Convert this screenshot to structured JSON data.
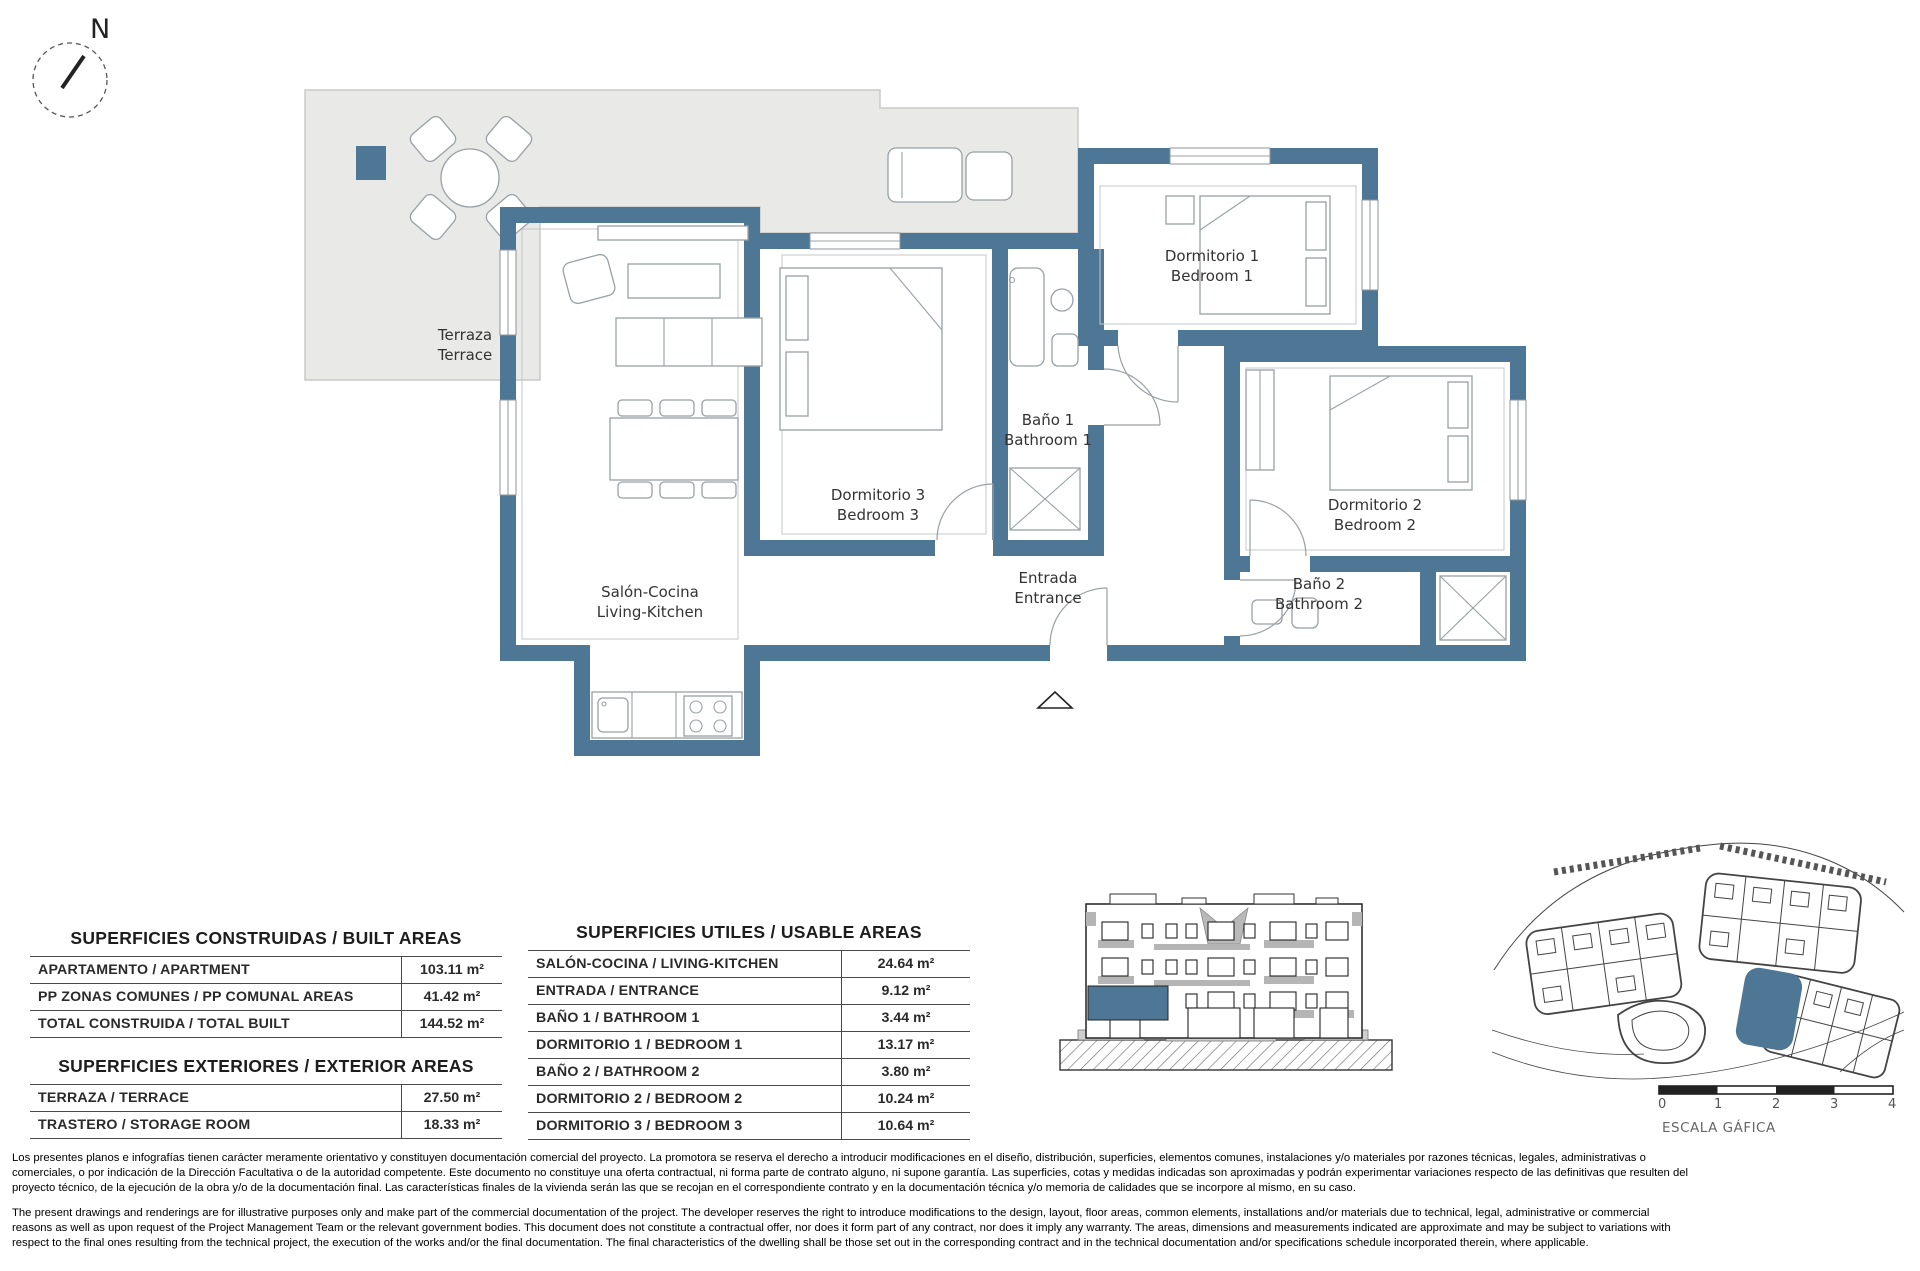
{
  "compass": {
    "north_label": "N"
  },
  "floor_plan": {
    "wall_color": "#4e7795",
    "terrace_color": "#e9e9e7",
    "rooms": [
      {
        "id": "terraza",
        "es": "Terraza",
        "en": "Terrace"
      },
      {
        "id": "salon",
        "es": "Salón-Cocina",
        "en": "Living-Kitchen"
      },
      {
        "id": "dorm3",
        "es": "Dormitorio 3",
        "en": "Bedroom 3"
      },
      {
        "id": "dorm1",
        "es": "Dormitorio 1",
        "en": "Bedroom 1"
      },
      {
        "id": "bano1",
        "es": "Baño 1",
        "en": "Bathroom 1"
      },
      {
        "id": "entrada",
        "es": "Entrada",
        "en": "Entrance"
      },
      {
        "id": "dorm2",
        "es": "Dormitorio 2",
        "en": "Bedroom 2"
      },
      {
        "id": "bano2",
        "es": "Baño 2",
        "en": "Bathroom 2"
      }
    ]
  },
  "areas_tables": {
    "built": {
      "title": "SUPERFICIES CONSTRUIDAS / BUILT AREAS",
      "rows": [
        {
          "label": "APARTAMENTO / APARTMENT",
          "value": "103.11 m²"
        },
        {
          "label": "PP ZONAS COMUNES / PP COMUNAL AREAS",
          "value": "41.42 m²"
        },
        {
          "label": "TOTAL CONSTRUIDA / TOTAL BUILT",
          "value": "144.52 m²"
        }
      ]
    },
    "exterior": {
      "title": "SUPERFICIES EXTERIORES / EXTERIOR AREAS",
      "rows": [
        {
          "label": "TERRAZA / TERRACE",
          "value": "27.50 m²"
        },
        {
          "label": "TRASTERO / STORAGE ROOM",
          "value": "18.33 m²"
        }
      ]
    },
    "usable": {
      "title": "SUPERFICIES UTILES / USABLE AREAS",
      "rows": [
        {
          "label": "SALÓN-COCINA / LIVING-KITCHEN",
          "value": "24.64 m²"
        },
        {
          "label": "ENTRADA / ENTRANCE",
          "value": "9.12 m²"
        },
        {
          "label": "BAÑO 1 / BATHROOM 1",
          "value": "3.44 m²"
        },
        {
          "label": "DORMITORIO 1 / BEDROOM 1",
          "value": "13.17 m²"
        },
        {
          "label": "BAÑO 2 / BATHROOM 2",
          "value": "3.80 m²"
        },
        {
          "label": "DORMITORIO 2 / BEDROOM 2",
          "value": "10.24 m²"
        },
        {
          "label": "DORMITORIO 3 / BEDROOM 3",
          "value": "10.64 m²"
        }
      ]
    }
  },
  "scale_bar": {
    "ticks": [
      "0",
      "1",
      "2",
      "3",
      "4"
    ],
    "label": "ESCALA GÁFICA"
  },
  "legal": {
    "es_lines": [
      "Los presentes planos e infografías tienen carácter meramente orientativo y constituyen documentación comercial del proyecto. La promotora se reserva el derecho a introducir modificaciones en el diseño, distribución, superficies, elementos comunes, instalaciones y/o materiales por razones técnicas, legales, administrativas o",
      "comerciales, o por indicación de la Dirección Facultativa o de la autoridad competente. Este documento no constituye una oferta contractual, ni forma parte de contrato alguno, ni supone garantía. Las superficies, cotas y medidas indicadas son aproximadas y podrán experimentar variaciones respecto de las definitivas que resulten del",
      "proyecto técnico, de la ejecución de la obra y/o de la documentación final. Las características finales de la vivienda serán las que se recojan en el correspondiente contrato y en la documentación técnica y/o memoria de calidades que se incorpore al mismo, en su caso."
    ],
    "en_lines": [
      "The present drawings and renderings are for illustrative purposes only and make part of the commercial documentation of the project. The developer reserves the right to introduce modifications to the design, layout, floor areas, common elements, installations and/or materials due to technical, legal, administrative or commercial",
      "reasons as well as upon request of the Project Management Team or the relevant government bodies. This document does not constitute a contractual offer, nor does it form part of any contract, nor does it imply any warranty. The areas, dimensions and measurements indicated are approximate and may be subject to variations with",
      "respect to the final ones resulting from the technical project, the execution of the works and/or the final documentation. The final characteristics of the dwelling shall be those set out in the corresponding contract and in the technical documentation and/or specifications schedule incorporated therein, where applicable."
    ]
  }
}
